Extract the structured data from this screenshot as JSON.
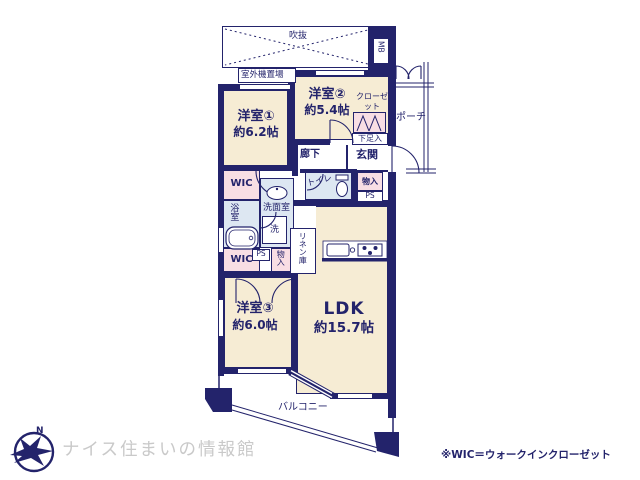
{
  "colors": {
    "wall_navy": "#23236b",
    "room_fill": "#f6ecd4",
    "closet_fill": "#f8dee4",
    "wet_area_fill": "#dde7f2",
    "logo_text_gray": "#c9c9c9"
  },
  "rooms": {
    "room1": {
      "name": "洋室①",
      "size": "約6.2帖"
    },
    "room2": {
      "name": "洋室②",
      "size": "約5.4帖"
    },
    "room3": {
      "name": "洋室③",
      "size": "約6.0帖"
    },
    "ldk": {
      "name": "LDK",
      "size": "約15.7帖"
    }
  },
  "labels": {
    "void": "吹抜",
    "meter_box": "MB",
    "outdoor_unit": "室外機置場",
    "closet": "クローゼット",
    "porch": "ポーチ",
    "shoe_storage": "下足入",
    "entrance": "玄関",
    "hallway": "廊下",
    "toilet": "トイレ",
    "storage": "物入",
    "pipe_space": "PS",
    "wic": "WIC",
    "bathroom": "浴室",
    "washroom": "洗面室",
    "washer": "洗",
    "linen_closet": "リネン庫",
    "balcony": "バルコニー"
  },
  "footer": {
    "logo_letter": "N",
    "logo_text": "ナイス住まいの情報館",
    "note": "※WIC＝ウォークインクローゼット"
  }
}
